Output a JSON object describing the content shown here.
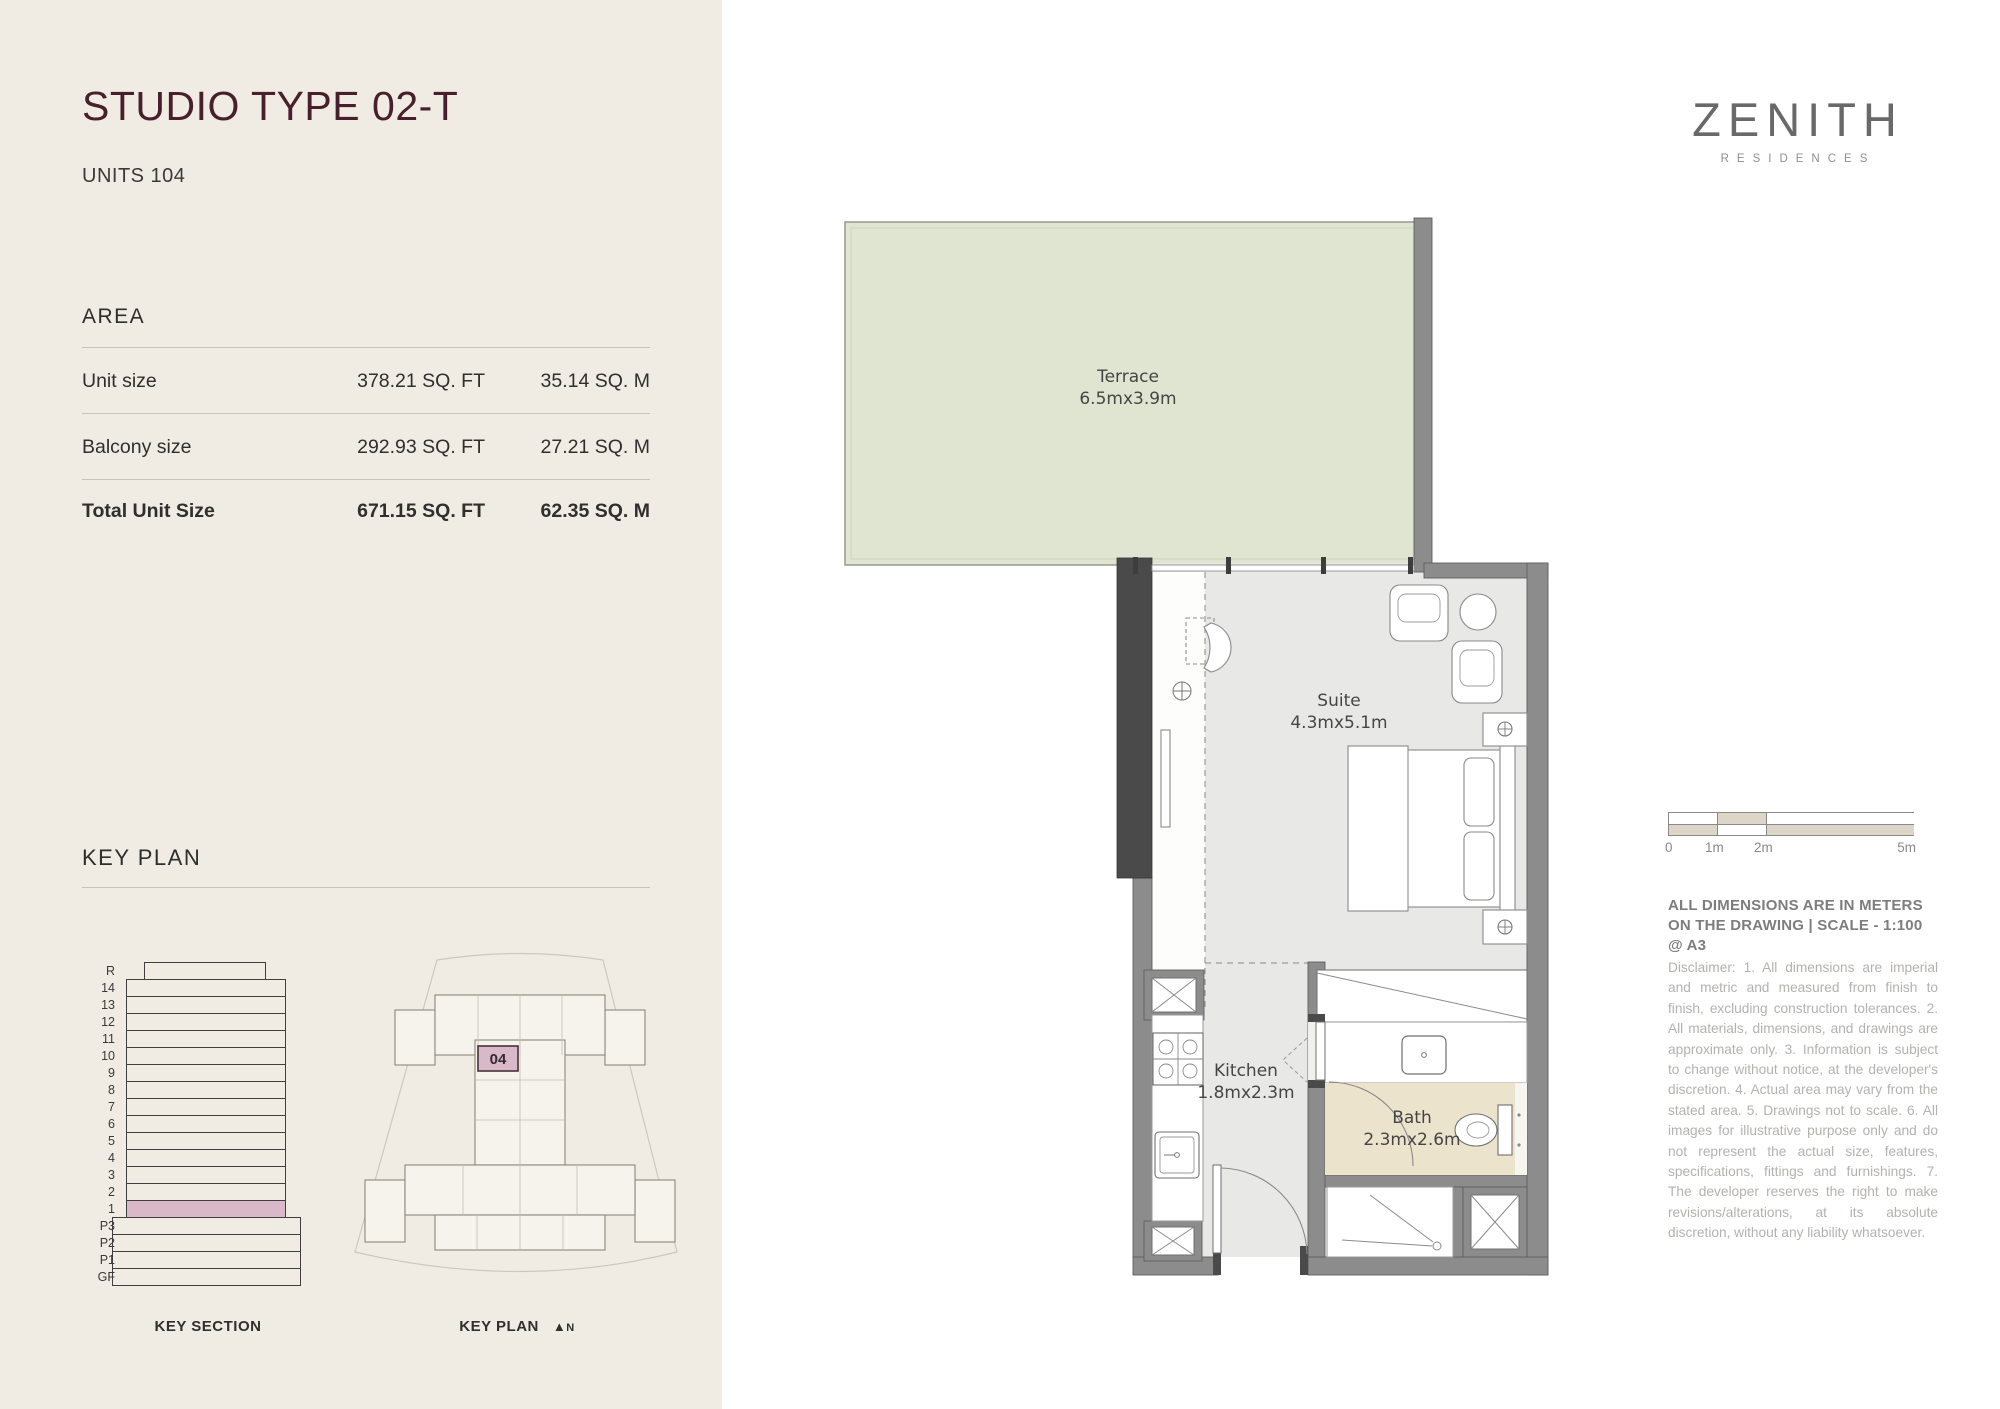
{
  "page": {
    "title": "STUDIO TYPE 02-T",
    "units": "UNITS 104"
  },
  "brand": {
    "name": "ZENITH",
    "tagline": "RESIDENCES"
  },
  "area": {
    "heading": "AREA",
    "rows": [
      {
        "label": "Unit size",
        "sqft": "378.21 SQ. FT",
        "sqm": "35.14 SQ. M"
      },
      {
        "label": "Balcony size",
        "sqft": "292.93 SQ. FT",
        "sqm": "27.21 SQ. M"
      },
      {
        "label": "Total Unit Size",
        "sqft": "671.15 SQ. FT",
        "sqm": "62.35 SQ. M"
      }
    ]
  },
  "key_plan": {
    "heading": "KEY PLAN",
    "section_caption": "KEY SECTION",
    "plan_caption": "KEY PLAN",
    "north_arrow_icon": "▲",
    "north_label": "N",
    "unit_number": "04",
    "floors": [
      "R",
      "14",
      "13",
      "12",
      "11",
      "10",
      "9",
      "8",
      "7",
      "6",
      "5",
      "4",
      "3",
      "2",
      "1",
      "P3",
      "P2",
      "P1",
      "GF"
    ],
    "highlighted_floor": "1",
    "highlight_color": "#d9b8c8"
  },
  "floor_plan": {
    "rooms": [
      {
        "name": "Terrace",
        "dims": "6.5mx3.9m"
      },
      {
        "name": "Suite",
        "dims": "4.3mx5.1m"
      },
      {
        "name": "Kitchen",
        "dims": "1.8mx2.3m"
      },
      {
        "name": "Bath",
        "dims": "2.3mx2.6m"
      }
    ],
    "colors": {
      "terrace": "#dfe5d0",
      "floor": "#e8e8e7",
      "bath": "#ece3cd",
      "wall": "#8c8c8c",
      "wall_dark": "#4a4a4a"
    }
  },
  "scale_bar": {
    "labels": [
      "0",
      "1m",
      "2m",
      "5m"
    ]
  },
  "notes": {
    "dimensions_note": "ALL DIMENSIONS ARE IN METERS ON THE DRAWING  |  SCALE - 1:100 @ A3",
    "disclaimer": "Disclaimer: 1. All dimensions are imperial and metric and measured from finish to finish, excluding construction tolerances. 2. All materials, dimensions, and drawings are approximate only. 3. Information is subject to change without notice, at the developer's discretion. 4. Actual area may vary from the stated area. 5. Drawings not to scale. 6. All images for illustrative purpose only and do not represent the actual size, features, specifications, fittings and furnishings. 7. The developer reserves the right to make revisions/alterations, at its absolute discretion, without any liability whatsoever."
  }
}
